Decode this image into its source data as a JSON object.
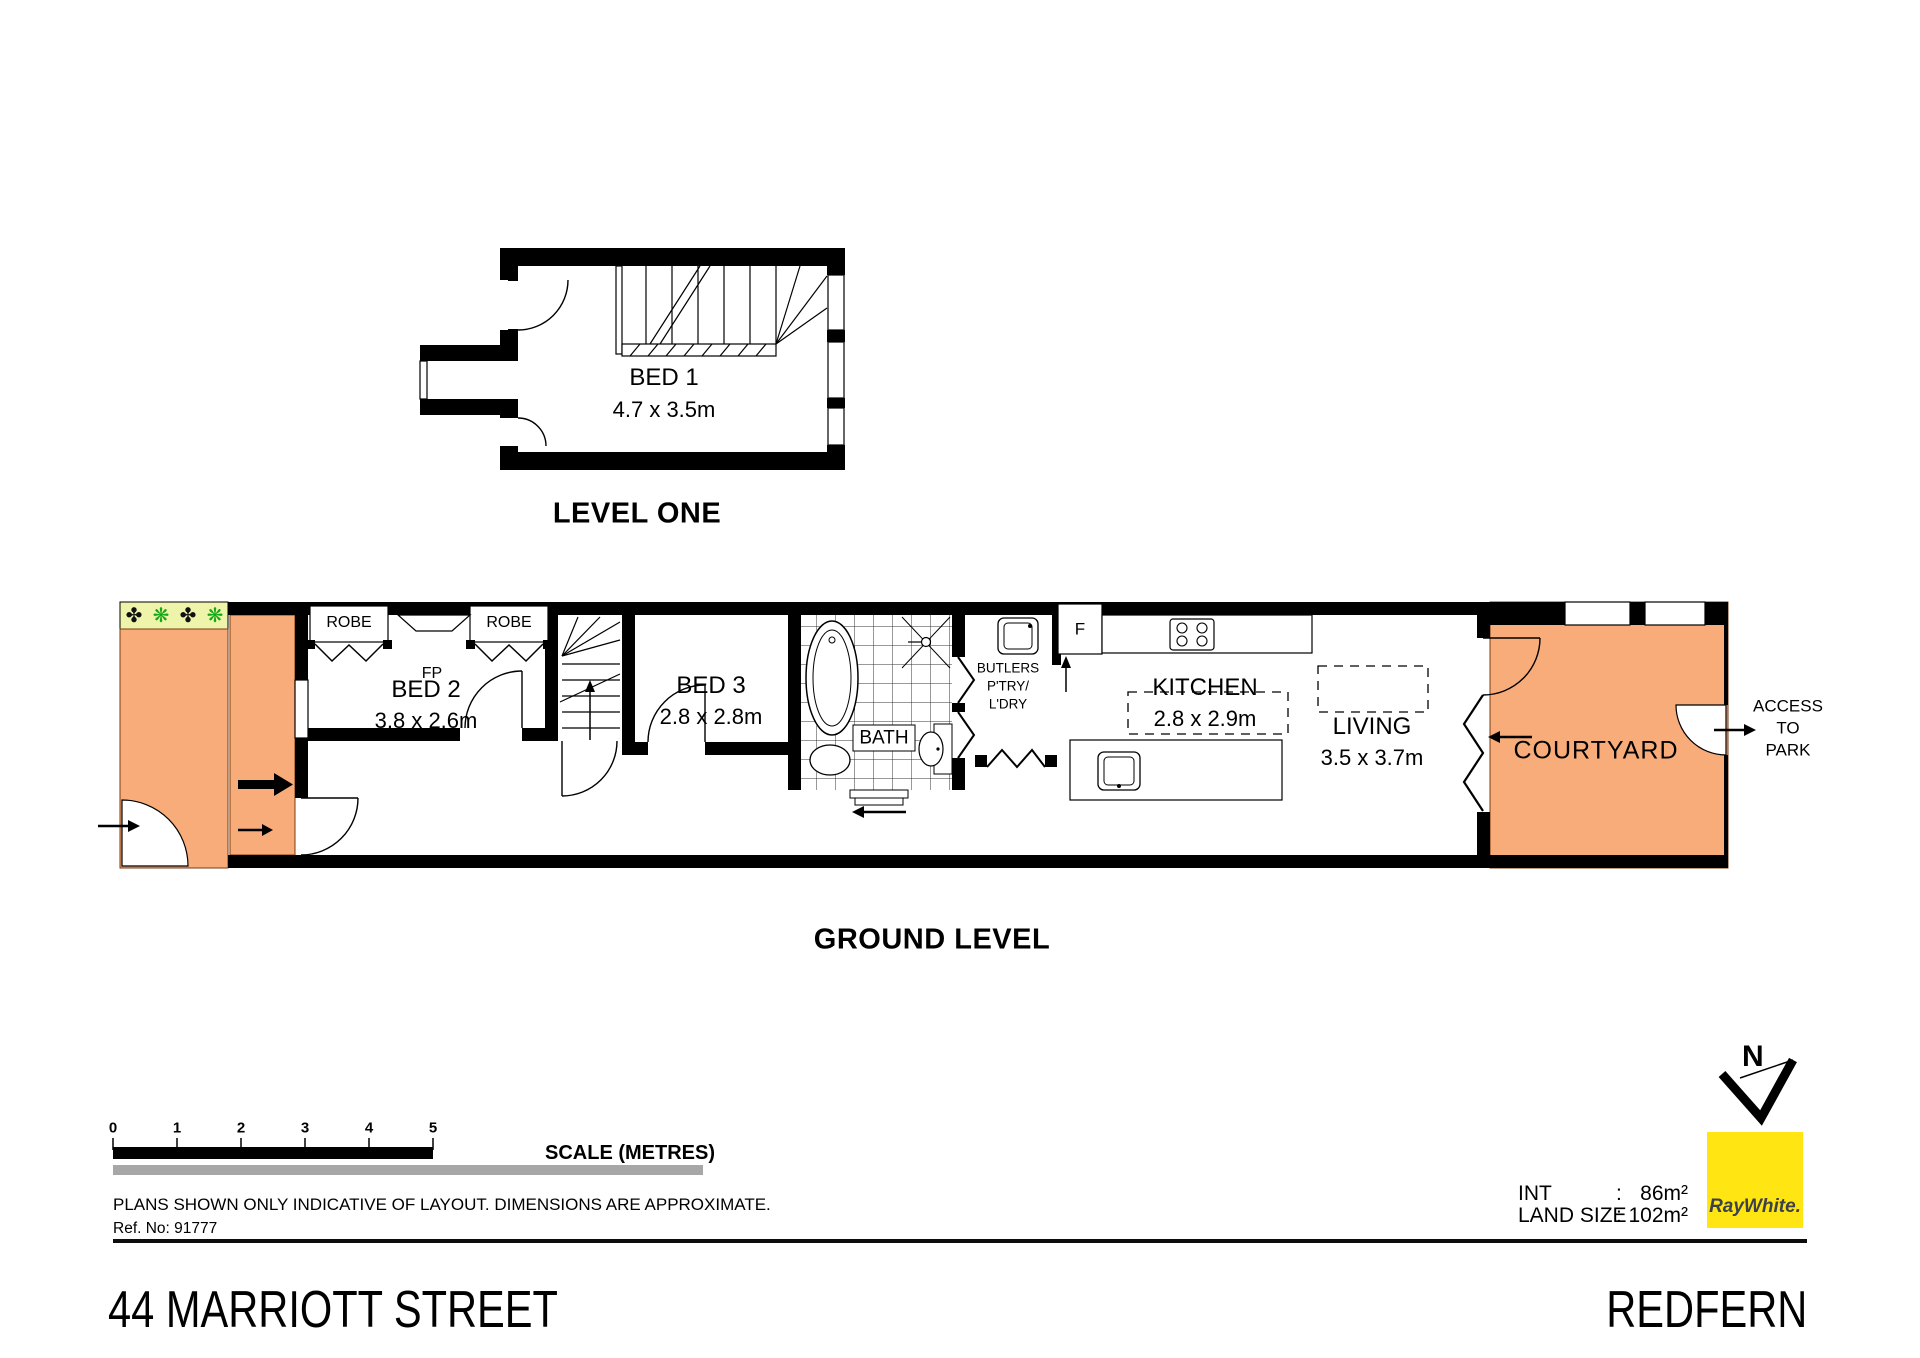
{
  "level_one": {
    "title": "LEVEL ONE",
    "bed1": {
      "name": "BED 1",
      "dims": "4.7 x 3.5m"
    }
  },
  "ground_level": {
    "title": "GROUND LEVEL",
    "robe_left": "ROBE",
    "robe_right": "ROBE",
    "fireplace": "FP",
    "bed2": {
      "name": "BED 2",
      "dims": "3.8 x 2.6m"
    },
    "bed3": {
      "name": "BED 3",
      "dims": "2.8 x 2.8m"
    },
    "bath": "BATH",
    "butlers": [
      "BUTLERS",
      "P'TRY/",
      "L'DRY"
    ],
    "fridge": "F",
    "kitchen": {
      "name": "KITCHEN",
      "dims": "2.8 x 2.9m"
    },
    "living": {
      "name": "LIVING",
      "dims": "3.5 x 3.7m"
    },
    "courtyard": "COURTYARD",
    "access": [
      "ACCESS",
      "TO",
      "PARK"
    ],
    "plants": [
      "✤",
      "❋",
      "✤",
      "❋"
    ]
  },
  "scale_bar": {
    "ticks": [
      "0",
      "1",
      "2",
      "3",
      "4",
      "5"
    ],
    "label": "SCALE (METRES)"
  },
  "notes": {
    "disclaimer": "PLANS SHOWN ONLY INDICATIVE OF LAYOUT.  DIMENSIONS ARE APPROXIMATE.",
    "ref": "Ref. No: 91777"
  },
  "areas": {
    "int_label": "INT",
    "int_sep": ":",
    "int_value": "86m²",
    "land_label": "LAND SIZE",
    "land_sep": ":",
    "land_value": "102m²"
  },
  "compass": {
    "north": "N"
  },
  "brand": {
    "name": "RayWhite.",
    "color": "#FFE512"
  },
  "footer": {
    "street": "44 MARRIOTT STREET",
    "suburb": "REDFERN"
  },
  "palette": {
    "outdoor_orange": "#F7AC79",
    "garden_green": "#EEF4A9",
    "grey_bar": "#A7A7A7"
  }
}
